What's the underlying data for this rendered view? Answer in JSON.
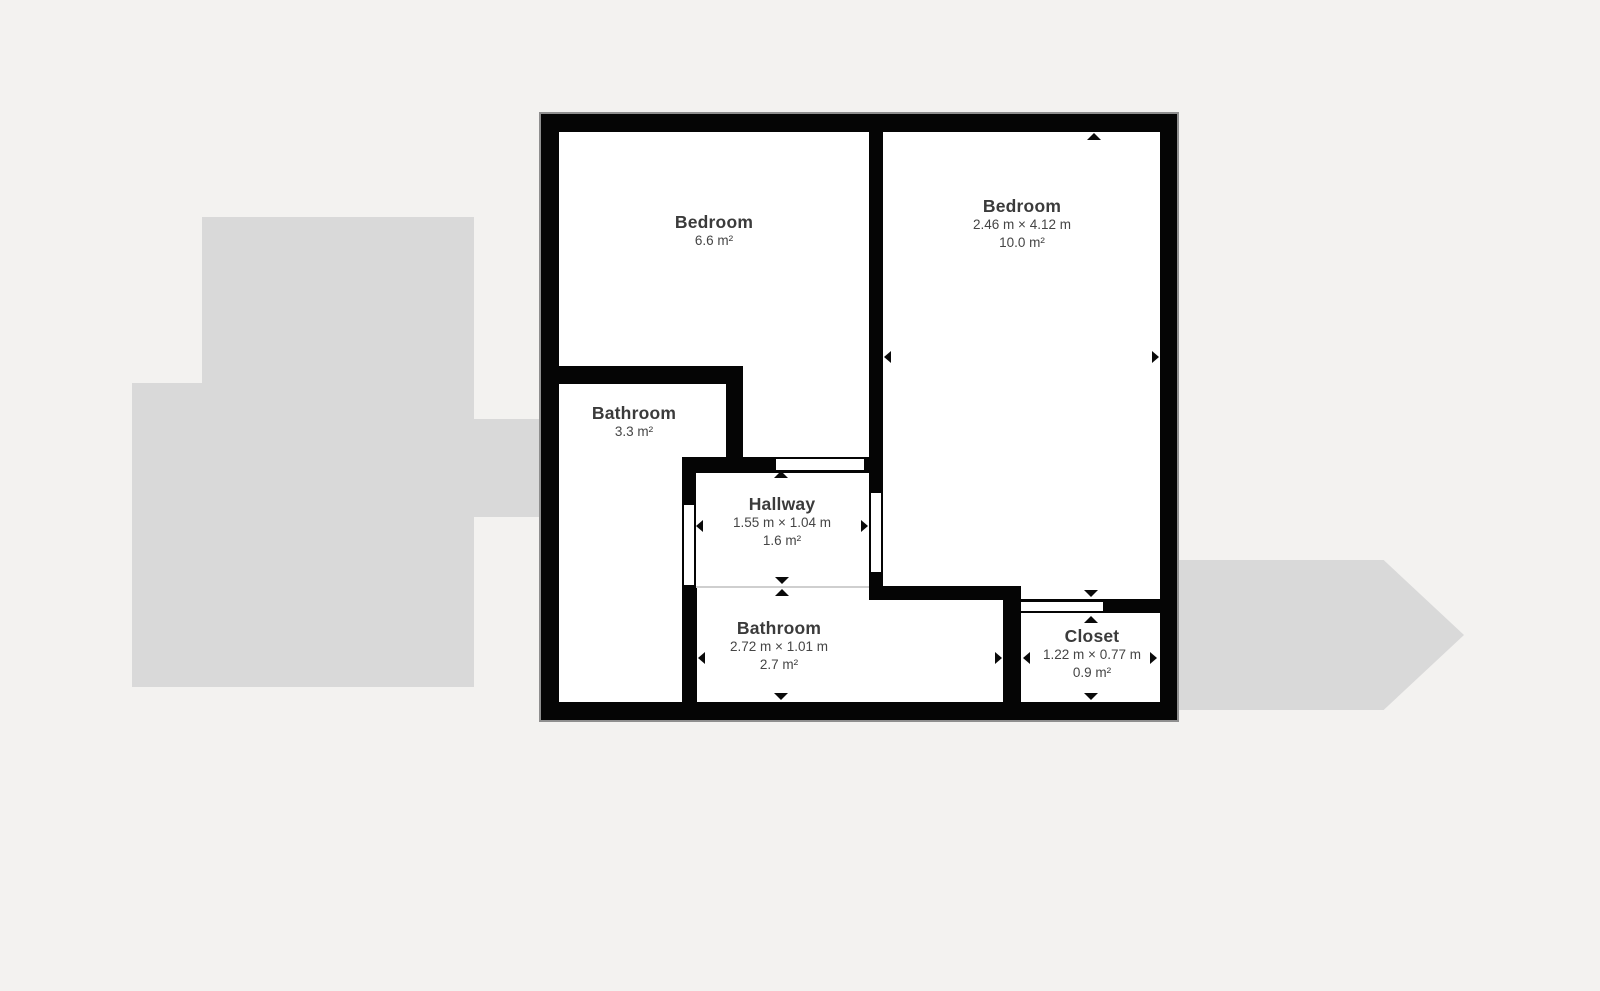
{
  "colors": {
    "background": "#f3f2f0",
    "adjacent": "#d9d9d9",
    "wall": "#050505",
    "floor": "#ffffff",
    "divider": "#cfcfcf",
    "marker": "#0a0a0a",
    "text_title": "#3b3b3b",
    "text_sub": "#454545",
    "outline": "#8f8f8f"
  },
  "rooms": [
    {
      "name": "Bedroom",
      "area": "6.6 m²"
    },
    {
      "name": "Bedroom",
      "dimensions": "2.46 m × 4.12 m",
      "area": "10.0 m²"
    },
    {
      "name": "Bathroom",
      "area": "3.3 m²"
    },
    {
      "name": "Hallway",
      "dimensions": "1.55 m × 1.04 m",
      "area": "1.6 m²"
    },
    {
      "name": "Bathroom",
      "dimensions": "2.72 m × 1.01 m",
      "area": "2.7 m²"
    },
    {
      "name": "Closet",
      "dimensions": "1.22 m × 0.77 m",
      "area": "0.9 m²"
    }
  ]
}
